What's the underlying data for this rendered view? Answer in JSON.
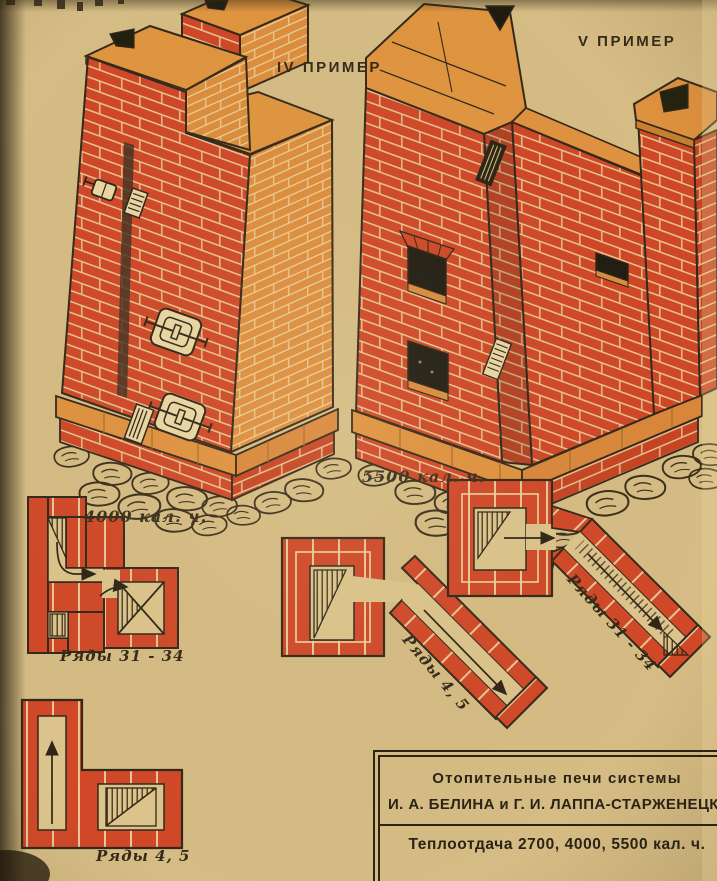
{
  "poster": {
    "stove_iv": {
      "example_label": "IV ПРИМЕР",
      "heat_label": "4000 кал. ч."
    },
    "stove_v": {
      "example_label": "V ПРИМЕР",
      "heat_label": "5500 кал. ч."
    },
    "plans": {
      "top_left_label": "Ряды 31 - 34",
      "bottom_left_label": "Ряды 4, 5",
      "middle_label": "Ряды 4, 5",
      "right_label": "Ряды 31 - 34"
    },
    "infobox": {
      "line1": "Отопительные печи системы",
      "line2": "И. А. БЕЛИНА и Г. И. ЛАППА-СТАРЖЕНЕЦКО",
      "line3": "Теплоотдача 2700, 4000, 5500 кал. ч."
    },
    "colors": {
      "paper": "#d5bc84",
      "brick_red": "#d04828",
      "brick_orange": "#dd8d3d",
      "ink": "#2e2517",
      "mortar": "#ead5a1"
    }
  }
}
